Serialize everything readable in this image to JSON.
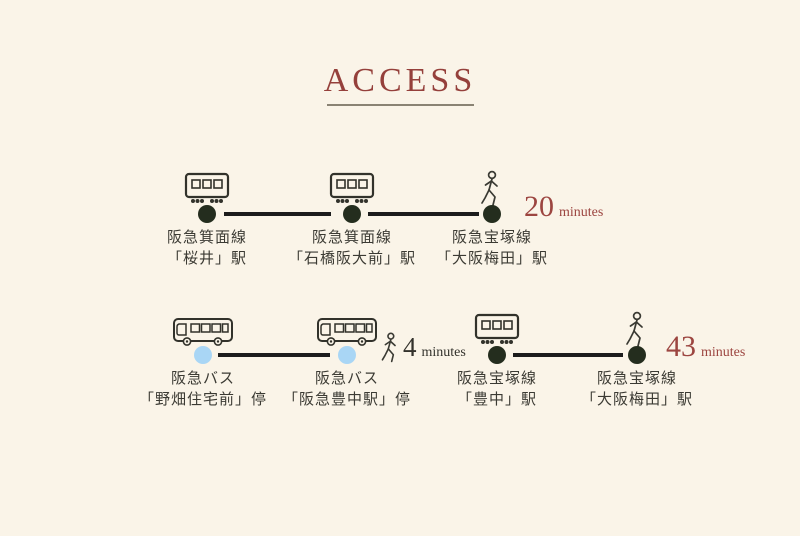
{
  "page": {
    "title": "ACCESS"
  },
  "colors": {
    "background": "#faf4e8",
    "accent_red": "#9c4540",
    "dark_dot": "#242d1e",
    "blue_dot": "#a9d6f5",
    "line": "#1c1c1c",
    "text": "#3b3a33"
  },
  "routes": [
    {
      "name": "train-route",
      "stops": [
        {
          "icon": "train-icon",
          "line1": "阪急箕面線",
          "line2": "「桜井」駅"
        },
        {
          "icon": "train-icon",
          "line1": "阪急箕面線",
          "line2": "「石橋阪大前」駅"
        },
        {
          "icon": "walk-icon",
          "line1": "阪急宝塚線",
          "line2": "「大阪梅田」駅"
        }
      ],
      "duration": {
        "value": "20",
        "unit": "minutes"
      }
    },
    {
      "name": "bus-route",
      "stops": [
        {
          "icon": "bus-icon",
          "line1": "阪急バス",
          "line2": "「野畑住宅前」停"
        },
        {
          "icon": "bus-icon",
          "line1": "阪急バス",
          "line2": "「阪急豊中駅」停"
        },
        {
          "icon": "train-icon",
          "line1": "阪急宝塚線",
          "line2": "「豊中」駅"
        },
        {
          "icon": "walk-icon",
          "line1": "阪急宝塚線",
          "line2": "「大阪梅田」駅"
        }
      ],
      "transfer": {
        "value": "4",
        "unit": "minutes"
      },
      "duration": {
        "value": "43",
        "unit": "minutes"
      }
    }
  ]
}
